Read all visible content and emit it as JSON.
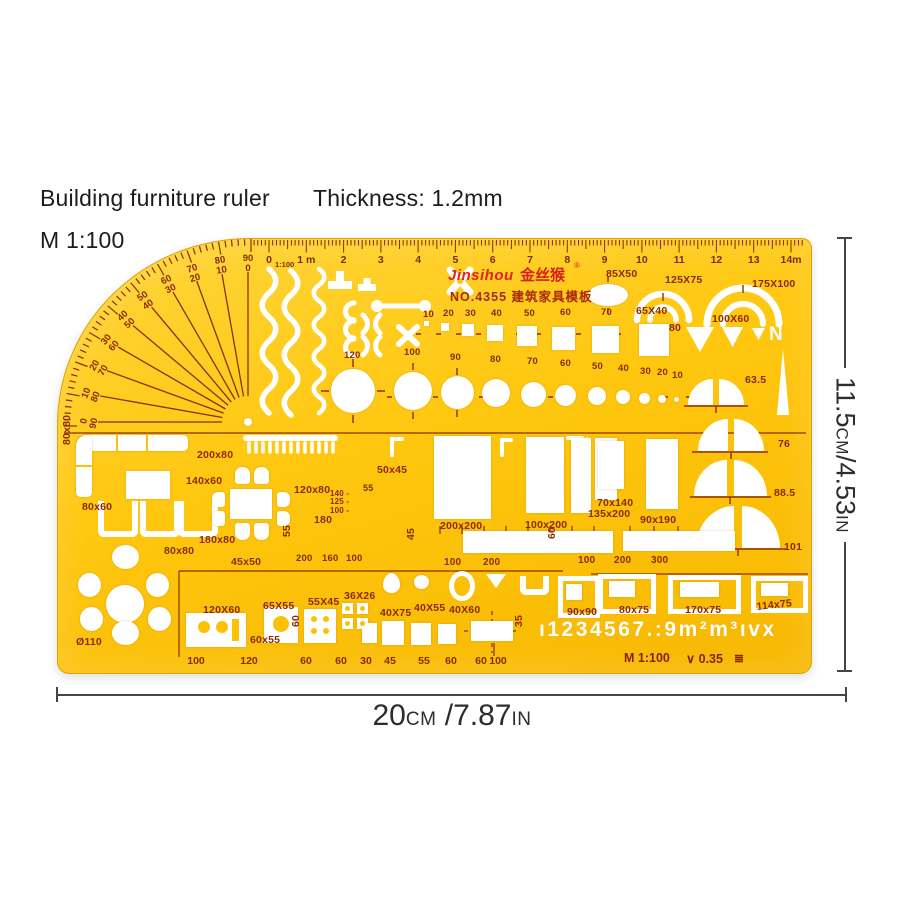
{
  "header": {
    "product_title": "Building furniture ruler",
    "thickness": "Thickness: 1.2mm",
    "scale": "M 1:100"
  },
  "dimension_width": {
    "num": "20",
    "unit": "cm",
    "num2": " /7.87",
    "unit2": "in"
  },
  "dimension_height": {
    "num": "11.5",
    "unit": "cm",
    "num2": "/4.53",
    "unit2": "in"
  },
  "branding": {
    "brand": "Jinsihou",
    "brand_cn": "金丝猴",
    "reg": "®",
    "model_line": "NO.4355 建筑家具模板"
  },
  "ruler": {
    "ratio": "1:100",
    "numbers": [
      "0",
      "1 m",
      "2",
      "3",
      "4",
      "5",
      "6",
      "7",
      "8",
      "9",
      "10",
      "11",
      "12",
      "13",
      "14m"
    ]
  },
  "protractor": {
    "pairs": [
      [
        "0",
        "90"
      ],
      [
        "10",
        "80"
      ],
      [
        "20",
        "70"
      ],
      [
        "30",
        "60"
      ],
      [
        "40",
        "50"
      ],
      [
        "50",
        "40"
      ],
      [
        "60",
        "30"
      ],
      [
        "70",
        "20"
      ],
      [
        "80",
        "10"
      ],
      [
        "90",
        "0"
      ]
    ]
  },
  "stencil": {
    "characters": "ı1234567.:9m²m³ıvx",
    "north": "N"
  },
  "footer": {
    "scale": "M 1:100",
    "pen_width": "∨ 0.35",
    "paper_icon": "≣"
  },
  "bottom_scale": [
    "100",
    "120",
    "60",
    "60",
    "30",
    "45",
    "55",
    "60",
    "60",
    "100"
  ],
  "labels": [
    {
      "t": "85X50",
      "x": 548,
      "y": 30
    },
    {
      "t": "125X75",
      "x": 607,
      "y": 36
    },
    {
      "t": "175X100",
      "x": 694,
      "y": 40
    },
    {
      "t": "65X40",
      "x": 578,
      "y": 67
    },
    {
      "t": "100X60",
      "x": 654,
      "y": 75
    },
    {
      "t": "80",
      "x": 611,
      "y": 84
    },
    {
      "t": "63.5",
      "x": 687,
      "y": 136
    },
    {
      "t": "76",
      "x": 720,
      "y": 200
    },
    {
      "t": "88.5",
      "x": 716,
      "y": 249
    },
    {
      "t": "101",
      "x": 726,
      "y": 303
    },
    {
      "t": "10",
      "x": 365,
      "y": 71,
      "fs": 9.5
    },
    {
      "t": "20",
      "x": 385,
      "y": 70,
      "fs": 9.5
    },
    {
      "t": "30",
      "x": 407,
      "y": 70,
      "fs": 9.5
    },
    {
      "t": "40",
      "x": 433,
      "y": 70,
      "fs": 9.5
    },
    {
      "t": "50",
      "x": 466,
      "y": 70,
      "fs": 9.5
    },
    {
      "t": "60",
      "x": 502,
      "y": 69,
      "fs": 9.5
    },
    {
      "t": "70",
      "x": 543,
      "y": 69,
      "fs": 9.5
    },
    {
      "t": "120",
      "x": 286,
      "y": 112,
      "fs": 9.5
    },
    {
      "t": "100",
      "x": 346,
      "y": 109,
      "fs": 9.5
    },
    {
      "t": "90",
      "x": 392,
      "y": 114,
      "fs": 9.5
    },
    {
      "t": "80",
      "x": 432,
      "y": 116,
      "fs": 9.5
    },
    {
      "t": "70",
      "x": 469,
      "y": 118,
      "fs": 9.5
    },
    {
      "t": "60",
      "x": 502,
      "y": 120,
      "fs": 9.5
    },
    {
      "t": "50",
      "x": 534,
      "y": 123,
      "fs": 9.5
    },
    {
      "t": "40",
      "x": 560,
      "y": 125,
      "fs": 9.5
    },
    {
      "t": "30",
      "x": 582,
      "y": 128,
      "fs": 9.5
    },
    {
      "t": "20",
      "x": 599,
      "y": 129,
      "fs": 9.5
    },
    {
      "t": "10",
      "x": 614,
      "y": 132,
      "fs": 9.5
    },
    {
      "t": "80x80",
      "x": 4,
      "y": 206,
      "rot": -90
    },
    {
      "t": "200x80",
      "x": 139,
      "y": 211
    },
    {
      "t": "140x60",
      "x": 128,
      "y": 237
    },
    {
      "t": "80x60",
      "x": 24,
      "y": 263
    },
    {
      "t": "120x80",
      "x": 236,
      "y": 246
    },
    {
      "t": "180",
      "x": 256,
      "y": 276
    },
    {
      "t": "180x80",
      "x": 141,
      "y": 296
    },
    {
      "t": "80x80",
      "x": 106,
      "y": 307
    },
    {
      "t": "55",
      "x": 224,
      "y": 298,
      "rot": -90
    },
    {
      "t": "45x50",
      "x": 173,
      "y": 318
    },
    {
      "t": "200",
      "x": 238,
      "y": 315,
      "fs": 9.5
    },
    {
      "t": "160",
      "x": 264,
      "y": 315,
      "fs": 9.5
    },
    {
      "t": "100",
      "x": 288,
      "y": 315,
      "fs": 9.5
    },
    {
      "t": "55",
      "x": 305,
      "y": 245,
      "fs": 9
    },
    {
      "t": "140 -",
      "x": 272,
      "y": 251,
      "fs": 8
    },
    {
      "t": "125 -",
      "x": 272,
      "y": 259,
      "fs": 8
    },
    {
      "t": "100 -",
      "x": 272,
      "y": 268,
      "fs": 8
    },
    {
      "t": "50x45",
      "x": 319,
      "y": 226
    },
    {
      "t": "200x200",
      "x": 382,
      "y": 282
    },
    {
      "t": "100x200",
      "x": 467,
      "y": 281
    },
    {
      "t": "45",
      "x": 348,
      "y": 301,
      "rot": -90
    },
    {
      "t": "60",
      "x": 489,
      "y": 300,
      "rot": -90
    },
    {
      "t": "100",
      "x": 386,
      "y": 319,
      "fs": 10
    },
    {
      "t": "200",
      "x": 425,
      "y": 319,
      "fs": 10
    },
    {
      "t": "70x140",
      "x": 539,
      "y": 259
    },
    {
      "t": "135x200",
      "x": 530,
      "y": 270
    },
    {
      "t": "90x190",
      "x": 582,
      "y": 276
    },
    {
      "t": "100",
      "x": 520,
      "y": 317,
      "fs": 10
    },
    {
      "t": "200",
      "x": 556,
      "y": 317,
      "fs": 10
    },
    {
      "t": "300",
      "x": 593,
      "y": 317,
      "fs": 10
    },
    {
      "t": "Ø110",
      "x": 18,
      "y": 398
    },
    {
      "t": "60x55",
      "x": 192,
      "y": 396
    },
    {
      "t": "60",
      "x": 233,
      "y": 388,
      "rot": -90
    },
    {
      "t": "120X60",
      "x": 145,
      "y": 366
    },
    {
      "t": "65X55",
      "x": 205,
      "y": 362
    },
    {
      "t": "55X45",
      "x": 250,
      "y": 358
    },
    {
      "t": "36X26",
      "x": 286,
      "y": 352
    },
    {
      "t": "40X75",
      "x": 322,
      "y": 369
    },
    {
      "t": "40X55",
      "x": 356,
      "y": 364
    },
    {
      "t": "40X60",
      "x": 391,
      "y": 366
    },
    {
      "t": "35",
      "x": 456,
      "y": 388,
      "rot": -90
    },
    {
      "t": "90x90",
      "x": 509,
      "y": 368
    },
    {
      "t": "80x75",
      "x": 561,
      "y": 366
    },
    {
      "t": "170x75",
      "x": 627,
      "y": 366
    },
    {
      "t": "114x75",
      "x": 698,
      "y": 363,
      "rot": -6
    }
  ]
}
